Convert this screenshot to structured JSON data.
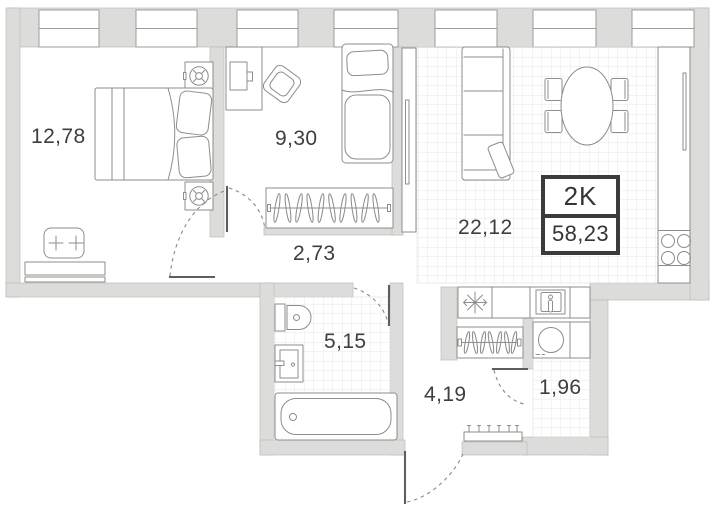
{
  "plan": {
    "unit": {
      "type_label": "2K",
      "total_area": "58,23"
    },
    "rooms": [
      {
        "id": "bedroom",
        "area": "12,78"
      },
      {
        "id": "child-room",
        "area": "9,30"
      },
      {
        "id": "inner-hallway",
        "area": "2,73"
      },
      {
        "id": "living-kitchen",
        "area": "22,12"
      },
      {
        "id": "bathroom",
        "area": "5,15"
      },
      {
        "id": "entry-hall",
        "area": "4,19"
      },
      {
        "id": "storage",
        "area": "1,96"
      }
    ],
    "colors": {
      "wall": "#dcdcda",
      "line": "#8d8d8b",
      "tile_grid": "#e7e9ea",
      "badge_border": "#3b3b3b",
      "label_text": "#3e3e3e"
    },
    "icons": {
      "fridge": "snowflake-icon",
      "stove": "four-burners-icon",
      "washer": "drum-circle-icon",
      "lamp": "ceiling-lamp-icon"
    }
  }
}
